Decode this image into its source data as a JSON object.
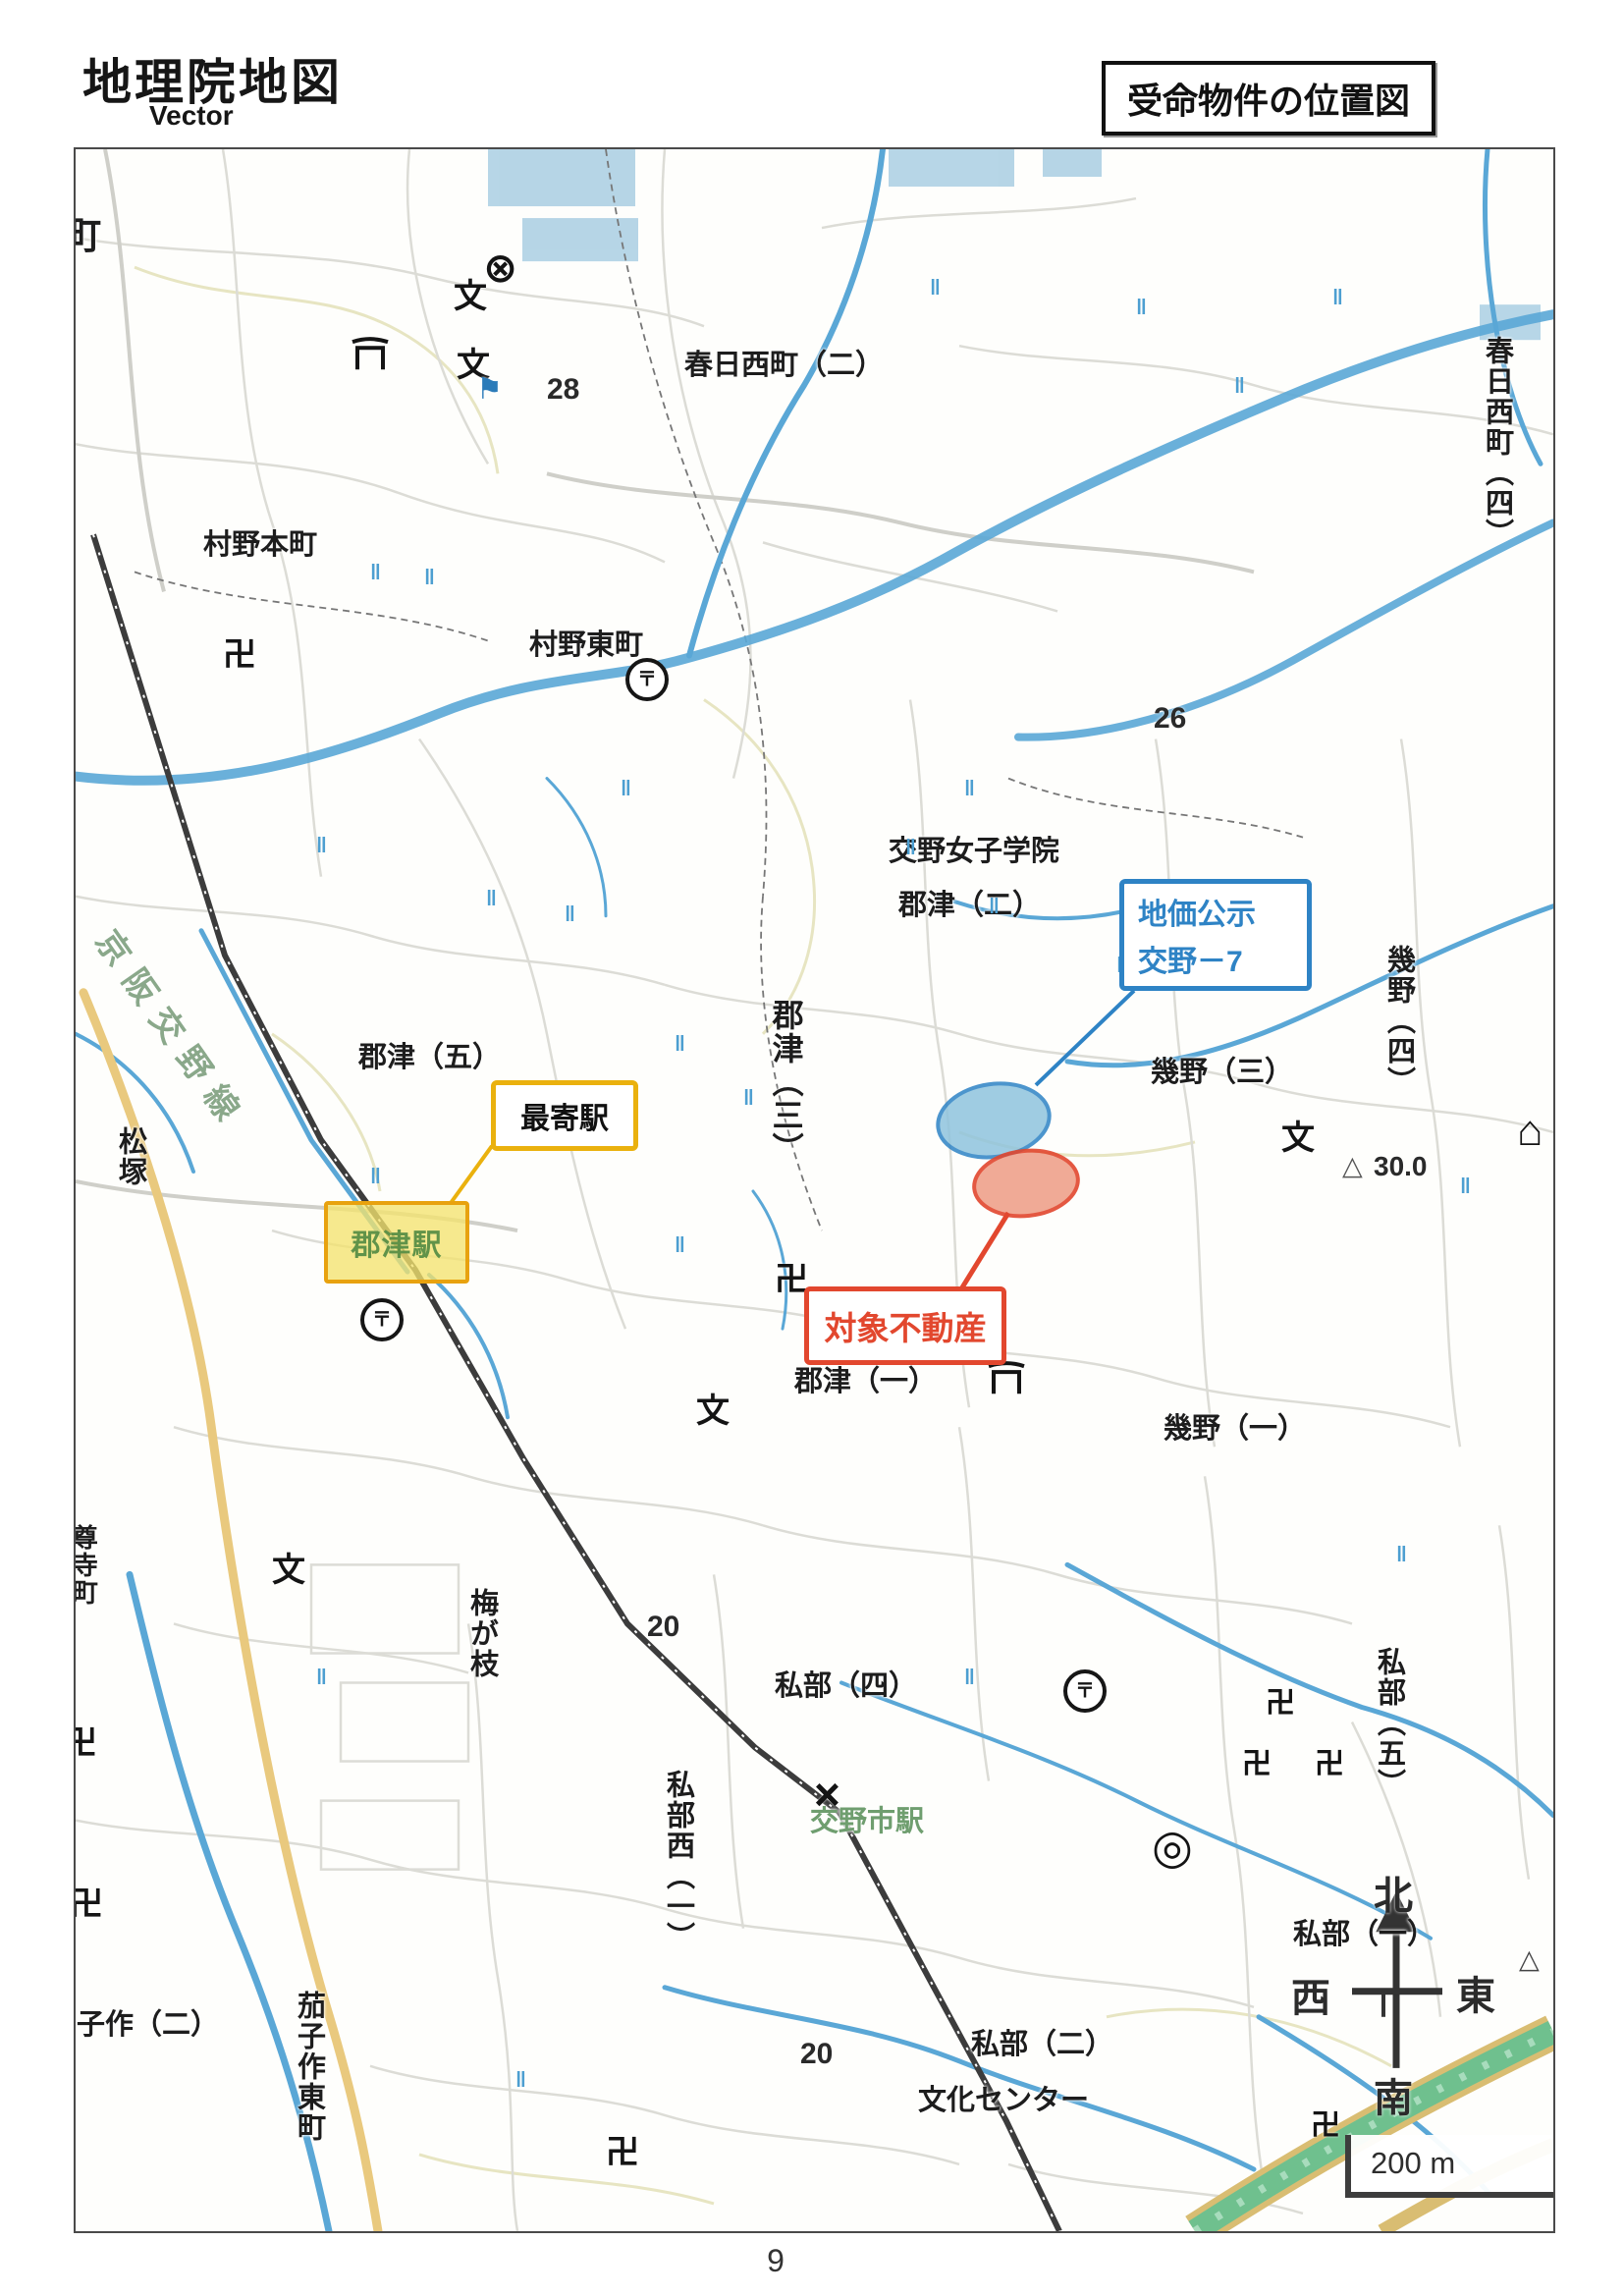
{
  "page": {
    "number": "9"
  },
  "header": {
    "title": "地理院地図",
    "subtitle": "Vector",
    "box_title": "受命物件の位置図"
  },
  "callouts": {
    "land_price": {
      "line1": "地価公示",
      "line2": "交野－7"
    },
    "subject_property": {
      "label": "対象不動産"
    },
    "nearest_station": {
      "label": "最寄駅"
    },
    "station_name": "郡津駅"
  },
  "compass": {
    "north": "北",
    "south": "南",
    "east": "東",
    "west": "西"
  },
  "scale": {
    "label": "200 m"
  },
  "map": {
    "labels": [
      {
        "text": "町"
      },
      {
        "text": "村野本町"
      },
      {
        "text": "村野東町"
      },
      {
        "text": "春日西町（二）"
      },
      {
        "text": "春日西町（四）"
      },
      {
        "text": "交野女子学院"
      },
      {
        "text": "郡津（二）"
      },
      {
        "text": "郡津（三）"
      },
      {
        "text": "郡津（五）"
      },
      {
        "text": "郡津（一）"
      },
      {
        "text": "幾野（三）"
      },
      {
        "text": "幾野（四）"
      },
      {
        "text": "幾野（一）"
      },
      {
        "text": "松塚"
      },
      {
        "text": "京阪交野線"
      },
      {
        "text": "梅が枝"
      },
      {
        "text": "私部（四）"
      },
      {
        "text": "私部西（一）"
      },
      {
        "text": "私部（五）"
      },
      {
        "text": "私部（一）"
      },
      {
        "text": "私部（二）"
      },
      {
        "text": "文化センター"
      },
      {
        "text": "茄子作（二）"
      },
      {
        "text": "茄子作東町"
      },
      {
        "text": "交野市駅"
      },
      {
        "text": "尊寺町"
      }
    ],
    "elevations": [
      "28",
      "26",
      "20",
      "20",
      "30.0"
    ],
    "icons": {
      "temple": {
        "name": "temple-icon",
        "glyph": "卍"
      },
      "school": {
        "name": "school-icon",
        "glyph": "文"
      },
      "post_office": {
        "name": "post-office-icon",
        "glyph": "〒"
      },
      "police": {
        "name": "police-station-icon",
        "glyph": "⊗"
      },
      "city_hall": {
        "name": "city-office-icon",
        "glyph": "◎"
      },
      "triangulation": {
        "name": "triangulation-point-icon",
        "glyph": "△"
      },
      "building": {
        "name": "building-icon",
        "glyph": "⌂"
      },
      "flag": {
        "name": "flag-icon",
        "glyph": "⚑"
      },
      "police_box": {
        "name": "police-box-icon",
        "glyph": "×"
      },
      "paddy": {
        "name": "paddy-field-icon",
        "glyph": "‖"
      },
      "shrine": {
        "name": "shrine-torii-icon",
        "glyph": "⛩"
      }
    }
  },
  "colors": {
    "accent_blue": "#2e83c5",
    "accent_red": "#e2472e",
    "accent_yellow": "#eab10e",
    "station_fill": "#f3e36e",
    "station_text_green": "#6f9e6f",
    "river_blue": "#5aa7d6",
    "road_gray": "#dcdcd6",
    "rail_dark": "#3c3c3c",
    "expressway_green": "#6fc08e",
    "yellow_road": "#e9c97e"
  }
}
